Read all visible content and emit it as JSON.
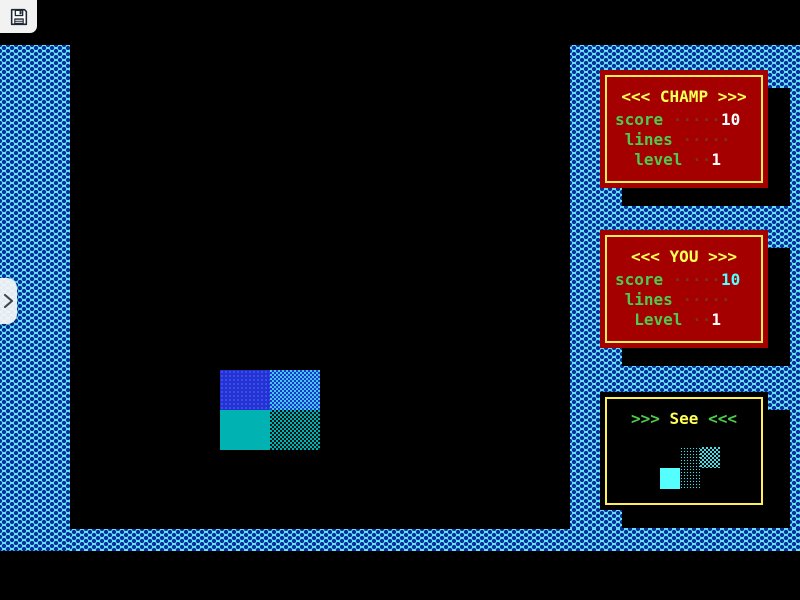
{
  "toolbar": {
    "save_icon": "floppy-disk"
  },
  "drawer": {
    "toggle_icon": "chevron-right"
  },
  "panels": {
    "champ": {
      "title": "<<< CHAMP >>>",
      "rows": [
        {
          "label": "score",
          "dots": " ·····",
          "value": "10"
        },
        {
          "label": " lines",
          "dots": " ·····",
          "value": ""
        },
        {
          "label": "  level",
          "dots": " ··",
          "value": "1"
        }
      ]
    },
    "you": {
      "title": "<<< YOU >>>",
      "rows": [
        {
          "label": "score",
          "dots": " ·····",
          "value": "10"
        },
        {
          "label": " lines",
          "dots": " ·····",
          "value": ""
        },
        {
          "label": "  Level",
          "dots": " ··",
          "value": "1"
        }
      ]
    },
    "preview": {
      "title_left": ">>>",
      "title_word": " See ",
      "title_right": "<<<",
      "piece": "S-piece cyan"
    }
  },
  "colors": {
    "wall_cyan": "#64e7f6",
    "wall_dot_navy": "#0a2f9e",
    "panel_red": "#a40000",
    "panel_border_yellow": "#ffee55",
    "title_yellow": "#ffff55",
    "label_green": "#4ecb4e",
    "dots_dark_red": "#7c3020",
    "champ_score_value": "#ffffff",
    "you_score_value": "#55ffff",
    "block_blue": "#2333d2",
    "block_blue_light": "#3ecbe4",
    "block_teal": "#00b2b2",
    "preview_cyan": "#55ffff"
  }
}
